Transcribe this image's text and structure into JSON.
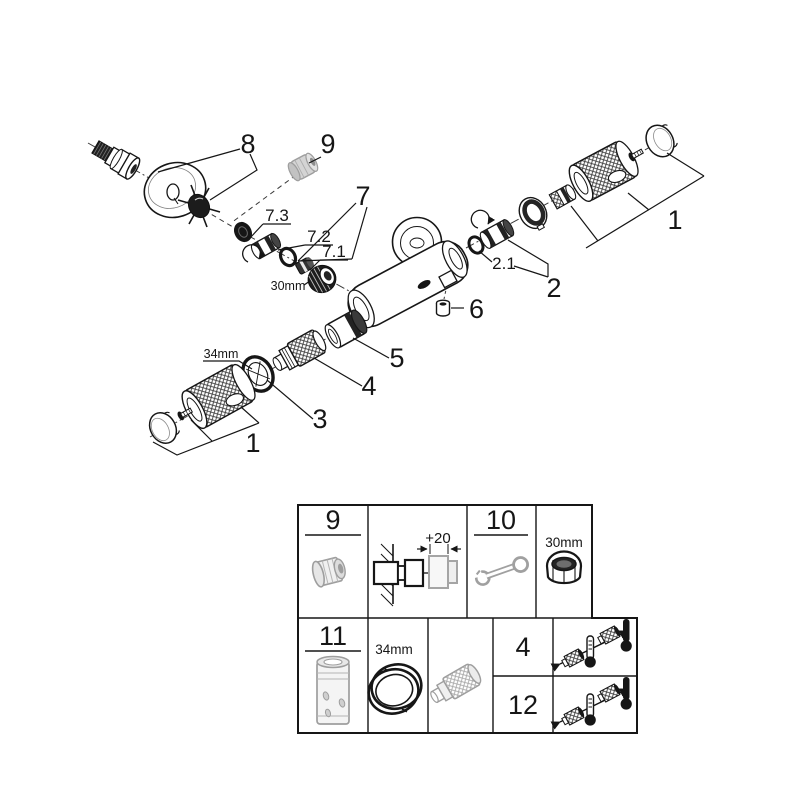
{
  "colors": {
    "ink": "#161616",
    "grey_part": "#9e9e9e",
    "grey_fill": "#ededed",
    "background": "#ffffff"
  },
  "exploded": {
    "labels": {
      "p8": "8",
      "p9": "9",
      "p7": "7",
      "p7_3": "7.3",
      "p7_2": "7.2",
      "p7_1": "7.1",
      "p1_right": "1",
      "p2": "2",
      "p2_1": "2.1",
      "p6": "6",
      "p5": "5",
      "p4": "4",
      "p3": "3",
      "p1_left": "1",
      "dim_30mm": "30mm",
      "dim_34mm": "34mm"
    }
  },
  "table": {
    "row1": {
      "cell9": "9",
      "wall_dim": "+20",
      "cell10": "10",
      "nut_dim": "30mm"
    },
    "row2": {
      "cell11": "11",
      "ring_dim": "34mm",
      "cell4": "4",
      "cell12": "12"
    }
  }
}
